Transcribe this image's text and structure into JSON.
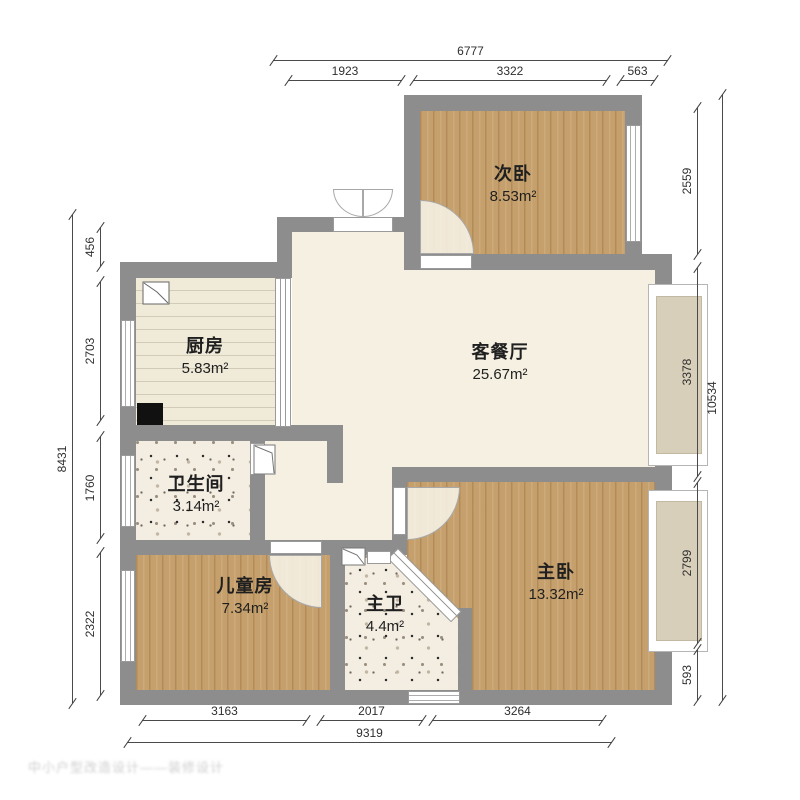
{
  "watermark": "中小户型改造设计——装修设计",
  "rooms": {
    "second_bedroom": {
      "name": "次卧",
      "area": "8.53m²"
    },
    "kitchen": {
      "name": "厨房",
      "area": "5.83m²"
    },
    "living_dining": {
      "name": "客餐厅",
      "area": "25.67m²"
    },
    "bathroom": {
      "name": "卫生间",
      "area": "3.14m²"
    },
    "kids_room": {
      "name": "儿童房",
      "area": "7.34m²"
    },
    "master_bathroom": {
      "name": "主卫",
      "area": "4.4m²"
    },
    "master_bedroom": {
      "name": "主卧",
      "area": "13.32m²"
    }
  },
  "dimensions": {
    "top": {
      "total": "6777",
      "segments": [
        "1923",
        "3322",
        "563"
      ]
    },
    "right": {
      "total": "10534",
      "segments": [
        "2559",
        "3378",
        "2799",
        "593"
      ]
    },
    "left": {
      "total": "8431",
      "segments": [
        "456",
        "2703",
        "1760",
        "2322"
      ]
    },
    "bottom": {
      "total": "9319",
      "segments": [
        "3163",
        "2017",
        "3264"
      ]
    }
  },
  "colors": {
    "wall": "#8d8d8d",
    "wood_floor": "#c6a06c",
    "kitchen_floor": "#f0ead9",
    "living_floor": "#f5f0e2",
    "bay_window": "#d8cfba",
    "dimension_line": "#4a4a4a"
  }
}
